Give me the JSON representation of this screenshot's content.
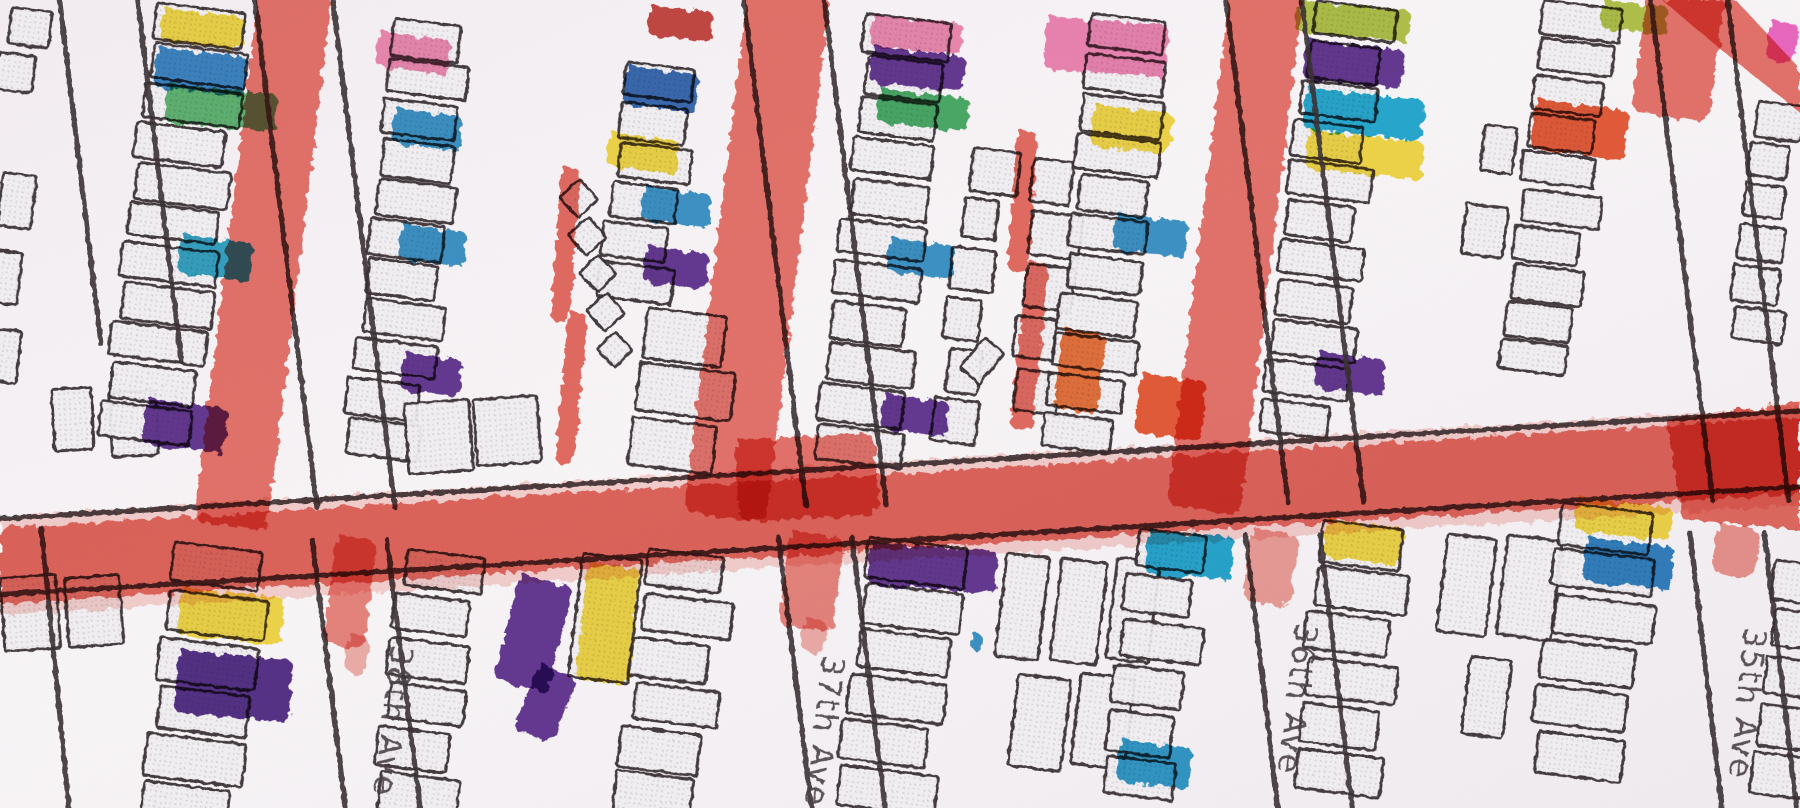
{
  "canvas": {
    "width": 1568,
    "height": 704
  },
  "palette": {
    "paper": "#f8f4f6",
    "paper_shade": "#efe9ee",
    "building_fill": "#efedf0",
    "building_dot": "#d6d0d5",
    "outline_dark": "#3a3236",
    "label_ink": "#4b4246",
    "street_red": "#e2544a",
    "yellow": "#f3d93a",
    "olive": "#aec23e",
    "green": "#55b46a",
    "deep_green": "#3da95c",
    "cyan": "#17a6cf",
    "blue": "#2e8fc6",
    "dark_blue": "#2a62ae",
    "teal": "#25a0c0",
    "purple": "#5a2a8c",
    "dark_purple": "#4a2080",
    "pink": "#ef84ae",
    "magenta": "#ee5fc0",
    "orange": "#ea6b2e",
    "red_orange": "#e8512c",
    "crimson": "#c23a34"
  },
  "streets": [
    {
      "name": "38th Ave"
    },
    {
      "name": "37th Ave"
    },
    {
      "name": "36th Ave"
    },
    {
      "name": "35th Ave"
    }
  ],
  "street_lines": [
    [
      0,
      452,
      1568,
      358
    ],
    [
      0,
      518,
      1568,
      424
    ],
    [
      222,
      0,
      276,
      442
    ],
    [
      290,
      0,
      344,
      442
    ],
    [
      272,
      470,
      301,
      704
    ],
    [
      337,
      470,
      366,
      704
    ],
    [
      648,
      0,
      702,
      440
    ],
    [
      718,
      0,
      772,
      440
    ],
    [
      678,
      468,
      707,
      704
    ],
    [
      742,
      468,
      771,
      704
    ],
    [
      1068,
      0,
      1122,
      438
    ],
    [
      1134,
      0,
      1188,
      438
    ],
    [
      1085,
      466,
      1113,
      704
    ],
    [
      1150,
      466,
      1178,
      704
    ],
    [
      1438,
      0,
      1492,
      436
    ],
    [
      1505,
      0,
      1558,
      436
    ],
    [
      1472,
      464,
      1500,
      704
    ],
    [
      1537,
      464,
      1565,
      704
    ],
    [
      52,
      0,
      88,
      300
    ],
    [
      120,
      0,
      158,
      315
    ],
    [
      36,
      460,
      60,
      704
    ]
  ],
  "red_streets": {
    "horizontal_halo": [
      [
        0,
        450
      ],
      [
        1568,
        354
      ],
      [
        1568,
        440
      ],
      [
        0,
        536
      ]
    ],
    "horizontal_band": [
      [
        0,
        460
      ],
      [
        1568,
        364
      ],
      [
        1568,
        430
      ],
      [
        0,
        526
      ]
    ],
    "segments": [
      [
        226,
        -12,
        64,
        470,
        7,
        0.8
      ],
      [
        652,
        -12,
        72,
        462,
        7,
        0.8
      ],
      [
        1072,
        -12,
        64,
        456,
        7,
        0.8
      ],
      [
        1436,
        -12,
        68,
        110,
        8,
        0.8
      ],
      [
        640,
        383,
        122,
        72,
        -3,
        0.8
      ],
      [
        293,
        466,
        36,
        96,
        7,
        0.7
      ],
      [
        303,
        552,
        20,
        34,
        7,
        0.45
      ],
      [
        688,
        462,
        48,
        84,
        7,
        0.7
      ],
      [
        700,
        538,
        22,
        30,
        7,
        0.45
      ],
      [
        1090,
        460,
        42,
        64,
        7,
        0.55
      ],
      [
        1496,
        456,
        38,
        44,
        7,
        0.6
      ]
    ],
    "polygons": [
      {
        "points": [
          [
            1448,
            0
          ],
          [
            1512,
            0
          ],
          [
            1568,
            60
          ],
          [
            1568,
            98
          ],
          [
            1500,
            44
          ]
        ],
        "opacity": 0.8
      },
      {
        "points": [
          [
            1452,
            366
          ],
          [
            1568,
            350
          ],
          [
            1568,
            462
          ],
          [
            1466,
            452
          ]
        ],
        "opacity": 0.85
      }
    ],
    "thin_lines": [
      [
        489,
        146,
        17,
        134,
        4,
        0.85
      ],
      [
        495,
        272,
        17,
        132,
        5,
        0.85
      ],
      [
        886,
        114,
        18,
        122,
        4,
        0.85
      ],
      [
        895,
        228,
        19,
        146,
        6,
        0.85
      ]
    ]
  },
  "building_stacks": [
    [
      8,
      6,
      7,
      2,
      30,
      30,
      10,
      "v"
    ],
    [
      2,
      150,
      7,
      3,
      30,
      44,
      24,
      "v"
    ],
    [
      45,
      342,
      -3,
      2,
      40,
      56,
      10,
      "h"
    ],
    [
      135,
      2,
      7,
      11,
      78,
      30,
      5,
      "v"
    ],
    [
      345,
      16,
      7,
      11,
      64,
      30,
      5,
      "v"
    ],
    [
      548,
      54,
      7,
      6,
      62,
      30,
      5,
      "v"
    ],
    [
      565,
      268,
      7,
      3,
      76,
      42,
      6,
      "v"
    ],
    [
      352,
      352,
      -4,
      2,
      52,
      60,
      8,
      "h"
    ],
    [
      758,
      12,
      7,
      11,
      70,
      31,
      5,
      "v"
    ],
    [
      845,
      128,
      7,
      6,
      36,
      36,
      8,
      "v"
    ],
    [
      905,
      138,
      7,
      5,
      38,
      38,
      8,
      "v"
    ],
    [
      955,
      12,
      7,
      11,
      66,
      30,
      5,
      "v"
    ],
    [
      1143,
      0,
      7,
      11,
      66,
      30,
      5,
      "v"
    ],
    [
      1290,
      108,
      7,
      2,
      34,
      42,
      28,
      "v"
    ],
    [
      1345,
      0,
      7,
      10,
      62,
      28,
      5,
      "v"
    ],
    [
      1532,
      88,
      7,
      6,
      40,
      30,
      6,
      "v"
    ],
    [
      0,
      505,
      -4,
      2,
      44,
      62,
      12,
      "h"
    ],
    [
      152,
      472,
      7,
      6,
      82,
      36,
      6,
      "v"
    ],
    [
      352,
      478,
      7,
      6,
      68,
      33,
      6,
      "v"
    ],
    [
      565,
      478,
      7,
      6,
      72,
      33,
      6,
      "v"
    ],
    [
      758,
      468,
      7,
      6,
      80,
      34,
      6,
      "v"
    ],
    [
      878,
      478,
      7,
      3,
      38,
      88,
      10,
      "h"
    ],
    [
      888,
      584,
      7,
      2,
      42,
      80,
      12,
      "h"
    ],
    [
      990,
      460,
      7,
      6,
      64,
      34,
      6,
      "v"
    ],
    [
      1152,
      453,
      7,
      6,
      72,
      34,
      6,
      "v"
    ],
    [
      1262,
      462,
      7,
      2,
      40,
      85,
      12,
      "h"
    ],
    [
      1285,
      572,
      7,
      1,
      42,
      70,
      0,
      "v"
    ],
    [
      1362,
      438,
      7,
      6,
      80,
      34,
      6,
      "v"
    ],
    [
      1548,
      488,
      7,
      5,
      40,
      34,
      8,
      "v"
    ]
  ],
  "extra_buildings": [
    [
      508,
      482,
      52,
      108,
      7
    ],
    [
      505,
      156,
      24,
      24,
      48
    ],
    [
      513,
      189,
      24,
      24,
      50
    ],
    [
      521,
      222,
      23,
      23,
      46
    ],
    [
      529,
      255,
      24,
      24,
      50
    ],
    [
      536,
      289,
      22,
      22,
      47
    ],
    [
      858,
      294,
      22,
      34,
      40
    ]
  ],
  "colored_buildings": [
    {
      "x": 142,
      "y": 7,
      "w": 72,
      "h": 29,
      "rot": 6,
      "color": "#f3d93a"
    },
    {
      "x": 137,
      "y": 41,
      "w": 80,
      "h": 35,
      "rot": 6,
      "color": "#2e7fc2"
    },
    {
      "x": 146,
      "y": 73,
      "w": 96,
      "h": 34,
      "rot": 5,
      "color": "#55b46a"
    },
    {
      "x": 158,
      "y": 204,
      "w": 64,
      "h": 34,
      "rot": 7,
      "color": "#25a0c0"
    },
    {
      "x": 128,
      "y": 347,
      "w": 72,
      "h": 40,
      "rot": 7,
      "color": "#5a2a8c"
    },
    {
      "x": 330,
      "y": 27,
      "w": 64,
      "h": 31,
      "rot": 7,
      "color": "#ef84ae"
    },
    {
      "x": 344,
      "y": 94,
      "w": 60,
      "h": 31,
      "rot": 7,
      "color": "#2e8fc6"
    },
    {
      "x": 350,
      "y": 195,
      "w": 58,
      "h": 31,
      "rot": 7,
      "color": "#2e8fc6"
    },
    {
      "x": 352,
      "y": 307,
      "w": 52,
      "h": 33,
      "rot": 7,
      "color": "#5a2a8c"
    },
    {
      "x": 566,
      "y": 5,
      "w": 56,
      "h": 26,
      "rot": 5,
      "color": "#c23a34"
    },
    {
      "x": 546,
      "y": 57,
      "w": 64,
      "h": 34,
      "rot": 7,
      "color": "#2a62ae"
    },
    {
      "x": 531,
      "y": 115,
      "w": 62,
      "h": 30,
      "rot": 7,
      "color": "#f3d93a"
    },
    {
      "x": 561,
      "y": 162,
      "w": 60,
      "h": 30,
      "rot": 7,
      "color": "#2e8fc6"
    },
    {
      "x": 563,
      "y": 214,
      "w": 56,
      "h": 32,
      "rot": 7,
      "color": "#5a2a8c"
    },
    {
      "x": 760,
      "y": 13,
      "w": 80,
      "h": 28,
      "rot": 5,
      "color": "#ef84ae"
    },
    {
      "x": 760,
      "y": 40,
      "w": 82,
      "h": 32,
      "rot": 6,
      "color": "#5a2a8c"
    },
    {
      "x": 766,
      "y": 77,
      "w": 80,
      "h": 30,
      "rot": 6,
      "color": "#3da95c"
    },
    {
      "x": 775,
      "y": 207,
      "w": 58,
      "h": 30,
      "rot": 7,
      "color": "#2e8fc6"
    },
    {
      "x": 770,
      "y": 343,
      "w": 58,
      "h": 31,
      "rot": 7,
      "color": "#5a2a8c"
    },
    {
      "x": 912,
      "y": 14,
      "w": 106,
      "h": 46,
      "rot": 4,
      "color": "#ef7fb0"
    },
    {
      "x": 953,
      "y": 91,
      "w": 70,
      "h": 36,
      "rot": 6,
      "color": "#f3d93a"
    },
    {
      "x": 972,
      "y": 186,
      "w": 64,
      "h": 32,
      "rot": 6,
      "color": "#2e8fc6"
    },
    {
      "x": 926,
      "y": 286,
      "w": 38,
      "h": 70,
      "rot": 7,
      "color": "#ea6b2e"
    },
    {
      "x": 994,
      "y": 325,
      "w": 58,
      "h": 52,
      "rot": 7,
      "color": "#e8512c"
    },
    {
      "x": 1130,
      "y": 0,
      "w": 100,
      "h": 28,
      "rot": 5,
      "color": "#aec23e"
    },
    {
      "x": 1138,
      "y": 34,
      "w": 86,
      "h": 35,
      "rot": 6,
      "color": "#5a2a8c"
    },
    {
      "x": 1138,
      "y": 76,
      "w": 104,
      "h": 36,
      "rot": 6,
      "color": "#17a6cf"
    },
    {
      "x": 1140,
      "y": 113,
      "w": 102,
      "h": 34,
      "rot": 6,
      "color": "#f3d93a"
    },
    {
      "x": 1148,
      "y": 306,
      "w": 60,
      "h": 32,
      "rot": 7,
      "color": "#5a2a8c"
    },
    {
      "x": 1338,
      "y": 86,
      "w": 82,
      "h": 44,
      "rot": 7,
      "color": "#e8512c"
    },
    {
      "x": 1396,
      "y": 0,
      "w": 58,
      "h": 25,
      "rot": 5,
      "color": "#aec23e"
    },
    {
      "x": 1542,
      "y": 18,
      "w": 26,
      "h": 34,
      "rot": 7,
      "color": "#ee5fc0"
    },
    {
      "x": 158,
      "y": 512,
      "w": 90,
      "h": 42,
      "rot": 5,
      "color": "#f3d93a"
    },
    {
      "x": 156,
      "y": 566,
      "w": 100,
      "h": 55,
      "rot": 5,
      "color": "#4a2080"
    },
    {
      "x": 453,
      "y": 500,
      "w": 48,
      "h": 95,
      "rot": 14,
      "color": "#5a2a8c"
    },
    {
      "x": 470,
      "y": 578,
      "w": 36,
      "h": 62,
      "rot": 22,
      "color": "#5a2a8c"
    },
    {
      "x": 512,
      "y": 490,
      "w": 46,
      "h": 102,
      "rot": 6,
      "color": "#f3d93a"
    },
    {
      "x": 758,
      "y": 472,
      "w": 112,
      "h": 37,
      "rot": 4,
      "color": "#5a2a8c"
    },
    {
      "x": 1000,
      "y": 462,
      "w": 76,
      "h": 38,
      "rot": 4,
      "color": "#16a4cf"
    },
    {
      "x": 976,
      "y": 644,
      "w": 64,
      "h": 36,
      "rot": 7,
      "color": "#2196c8"
    },
    {
      "x": 1156,
      "y": 452,
      "w": 68,
      "h": 33,
      "rot": 7,
      "color": "#f3d93a"
    },
    {
      "x": 1374,
      "y": 433,
      "w": 84,
      "h": 30,
      "rot": 6,
      "color": "#f3d93a"
    },
    {
      "x": 1382,
      "y": 468,
      "w": 78,
      "h": 38,
      "rot": 6,
      "color": "#2079be"
    },
    {
      "x": 846,
      "y": 552,
      "w": 12,
      "h": 14,
      "rot": 7,
      "color": "#2e8fc6"
    }
  ]
}
